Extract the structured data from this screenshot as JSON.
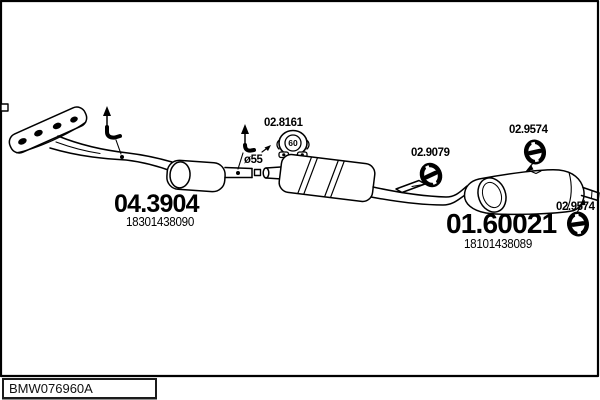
{
  "diagram": {
    "footer_code": "BMW076960A",
    "front_section": {
      "code": "04.3904",
      "oem": "18301438090"
    },
    "rear_section": {
      "code": "01.60021",
      "oem": "18101438089"
    },
    "clamp": {
      "code": "02.8161",
      "size": "60"
    },
    "pipe_diameter": "ø55",
    "hanger_mid": {
      "code": "02.9079"
    },
    "hanger_top": {
      "code": "02.9574"
    },
    "hanger_rear": {
      "code": "02.9574"
    }
  },
  "colors": {
    "line": "#000000",
    "background": "#ffffff"
  }
}
